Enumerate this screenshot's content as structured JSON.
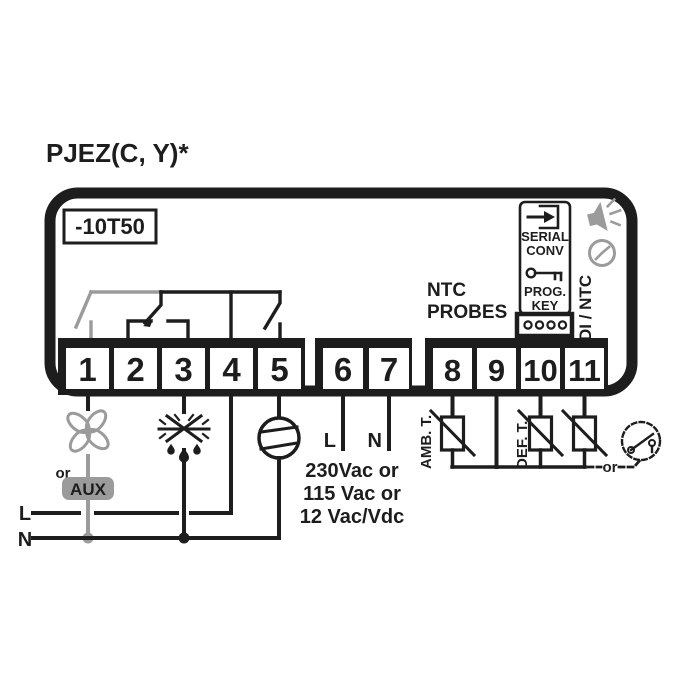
{
  "title": "PJEZ(C, Y)*",
  "device": {
    "model_range": "-10T50",
    "terminals": [
      "1",
      "2",
      "3",
      "4",
      "5",
      "6",
      "7",
      "8",
      "9",
      "10",
      "11"
    ],
    "serial_conv_label": [
      "SERIAL",
      "CONV"
    ],
    "prog_key_label": [
      "PROG.",
      "KEY"
    ],
    "di_ntc_label": "DI / NTC"
  },
  "outputs": {
    "or_label": "or",
    "aux_label": "AUX",
    "line_label": "L",
    "neutral_label": "N"
  },
  "power": {
    "line_label": "L",
    "neutral_label": "N",
    "voltage_lines": [
      "230Vac or",
      "115 Vac or",
      "12 Vac/Vdc"
    ]
  },
  "probes": {
    "header": [
      "NTC",
      "PROBES"
    ],
    "ambient_label": "AMB. T.",
    "defrost_label": "DEF. T.",
    "or_label": "or"
  },
  "icons": [
    "buzzer-icon",
    "clock-icon",
    "serial-conv-icon",
    "prog-key-icon",
    "4pin-connector",
    "fan-icon",
    "defrost-icon",
    "compressor-icon",
    "ntc-probe-symbol",
    "door-switch-icon"
  ],
  "colors": {
    "ink": "#1d1d1d",
    "gray": "#9b9b9b",
    "background": "#ffffff"
  }
}
